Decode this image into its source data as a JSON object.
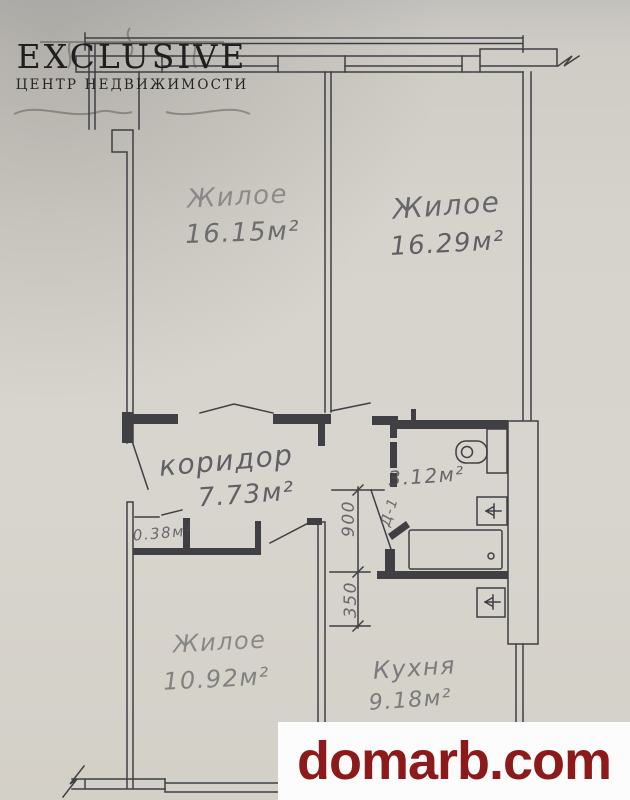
{
  "branding": {
    "agency_name": "EXCLUSIVE",
    "agency_tagline": "ЦЕНТР НЕДВИЖИМОСТИ",
    "site_watermark": "domarb.com"
  },
  "floorplan": {
    "rooms": [
      {
        "id": "living-room-1",
        "label": "Жилое",
        "area": "16.15м²"
      },
      {
        "id": "living-room-2",
        "label": "Жилое",
        "area": "16.29м²"
      },
      {
        "id": "corridor",
        "label": "коридор",
        "area": "7.73м²"
      },
      {
        "id": "bathroom",
        "label": "",
        "area": "3.12м²"
      },
      {
        "id": "closet",
        "label": "",
        "area": "0.38м²"
      },
      {
        "id": "living-room-3",
        "label": "Жилое",
        "area": "10.92м²"
      },
      {
        "id": "kitchen",
        "label": "Кухня",
        "area": "9.18м²"
      }
    ],
    "dimension_labels": [
      "900",
      "350"
    ],
    "door_tag": "Д-1"
  },
  "colors": {
    "paper": "#d6d3cc",
    "ink": "#3f3f44",
    "logo_ink": "#1f1f20",
    "watermark_red": "#8c1a1a",
    "band_background": "#fcfcfc"
  }
}
